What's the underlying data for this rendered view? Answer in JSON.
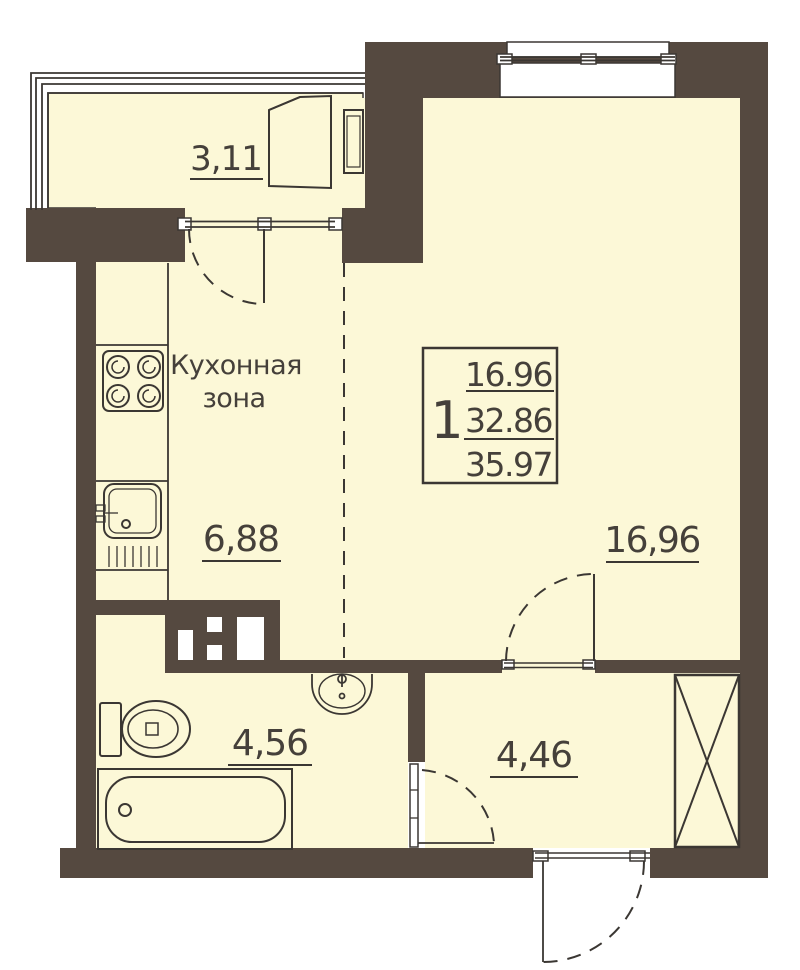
{
  "colors": {
    "wall": "#554940",
    "floor": "#FCF8D7",
    "line": "#3B3733",
    "text": "#45403A",
    "white": "#FFFFFF"
  },
  "unit_card": {
    "rooms": "1",
    "living_area": "16.96",
    "apartment_area": "32.86",
    "total_area": "35.97"
  },
  "areas": {
    "balcony": "3,11",
    "kitchen": "6,88",
    "room": "16,96",
    "bathroom": "4,56",
    "hallway": "4,46"
  },
  "kitchen_zone": {
    "line1": "Кухонная",
    "line2": "зона"
  }
}
